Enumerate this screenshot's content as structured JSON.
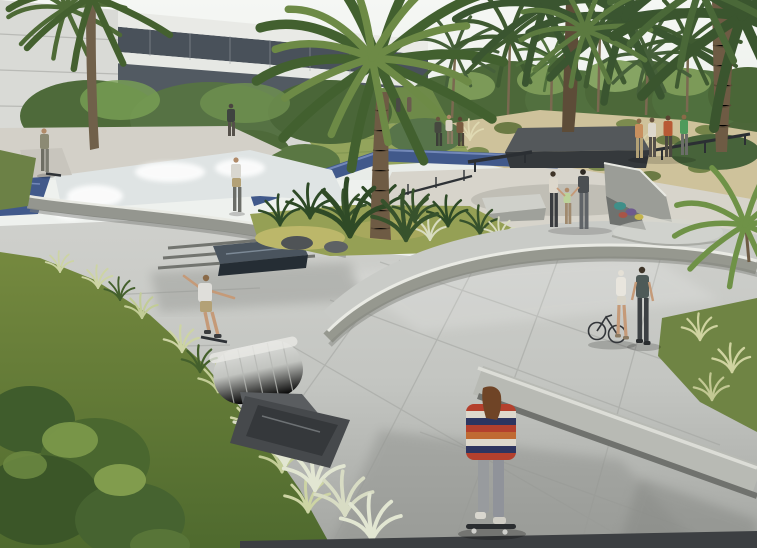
{
  "scene": {
    "type": "architectural-rendering",
    "subject": "skatepark plaza with palm trees, modern white buildings, lawns and water features",
    "figures": [
      "person-with-skateboard-top-left-deck",
      "person-standing-by-building",
      "person-standing-at-bowl-edge",
      "skater-riding-onto-roller",
      "foreground-skater-striped-shirt",
      "woman-pushing-bicycle",
      "man-walking-beside-bicycle",
      "family-of-three-holding-hands",
      "group-of-four-standing",
      "people-walking-on-blue-path"
    ]
  },
  "colors": {
    "sky": "#f2f5f1",
    "building_white": "#e9eae6",
    "building_shadow": "#c9cac6",
    "glazing": "#49515a",
    "tree_dark": "#4c6639",
    "tree_mid": "#5f7c46",
    "tree_light": "#84a05c",
    "palm_dark": "#3a552e",
    "palm_mid": "#5d7a41",
    "palm_light": "#7f9c54",
    "trunk": "#6e5b44",
    "trunk_dark": "#574734",
    "meadow": "#cec29b",
    "meadow_shrub": "#6b7a44",
    "lawn": "#6e8a49",
    "lawn_yellow": "#93a45c",
    "water_blue": "#41598b",
    "water_blue_light": "#7388b8",
    "path_warm": "#d7d4cb",
    "concrete_light": "#d0d1cd",
    "concrete_mid": "#a8aaa6",
    "concrete_dark": "#8e908c",
    "coping": "#e9eae4",
    "planter_box": "#35393c",
    "ledge_blue": "#4a545e",
    "rock": "#4f5356",
    "grass_base": "#6f8444",
    "grass_light": "#cdd4a4",
    "grass_white": "#e2e6d2",
    "pit_dark": "#46494c",
    "spray": "#eef1f0",
    "skin": "#c59a78",
    "shirt_white": "#dfdeda",
    "shorts_khaki": "#b3a176",
    "stripe_red": "#b4402d",
    "stripe_navy": "#2e3560",
    "stripe_white": "#ddd8cc",
    "stripe_orange": "#c06a33",
    "jeans": "#989b9e",
    "hair_auburn": "#6f4426",
    "shirt_green": "#4f9a5b",
    "shirt_redorange": "#b85a35",
    "shirt_orangetan": "#c88f5e",
    "rail_dark": "#2e3236",
    "graffiti_teal": "#3f8f89",
    "graffiti_purple": "#6d5a8e",
    "graffiti_yellow": "#c4b44c",
    "bottom_band": "#3c3f42"
  }
}
